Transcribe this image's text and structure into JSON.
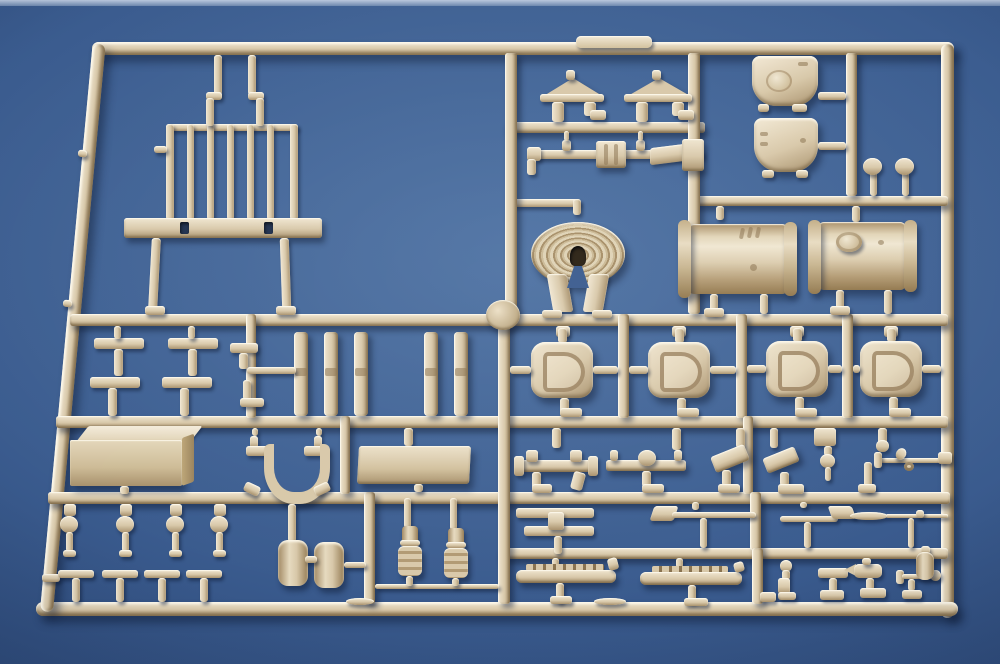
{
  "scene": {
    "type": "photograph",
    "subject": "tan injection-molded plastic model-kit sprue (parts frame) lying on blue felt backdrop",
    "visible_text": "",
    "palette": {
      "bg1": "#4e72a3",
      "bg2": "#3a5b8e",
      "bg3": "#27416e",
      "strip": "#aebfd8",
      "thi": "#f0e6d1",
      "tmid": "#d8c8a9",
      "tlo": "#a8916c",
      "tdk": "#8a7350",
      "hole": "#20314f",
      "cast": "rgba(13,26,50,0.48)",
      "hl": "rgba(255,252,240,0.9)",
      "cr": "rgba(100,80,50,0.55)"
    }
  },
  "sprue": {
    "plastic_color_name": "tan / dark-yellow styrene",
    "frame_shape": "rounded rectangle, left rail slanted by perspective",
    "label_tab_text": "",
    "parts_inventory": [
      {
        "name": "handrail-grille",
        "count": 1
      },
      {
        "name": "roof-shaped-bracket",
        "count": 2
      },
      {
        "name": "axle-rod",
        "count": 1
      },
      {
        "name": "coiled-cable-reel",
        "count": 1
      },
      {
        "name": "curved-stowage-panel",
        "count": 2
      },
      {
        "name": "mushroom-head-pin",
        "count": 2
      },
      {
        "name": "cylindrical-fuel-tank",
        "count": 2
      },
      {
        "name": "d-shaped-hatch-cover",
        "count": 4
      },
      {
        "name": "link-strut",
        "count": 5
      },
      {
        "name": "t-handle-lever",
        "count": 5
      },
      {
        "name": "stowage-box",
        "count": 1
      },
      {
        "name": "mounting-plate",
        "count": 1
      },
      {
        "name": "tow-shackle",
        "count": 1
      },
      {
        "name": "ball-head-pin",
        "count": 4
      },
      {
        "name": "tee-pin",
        "count": 4
      },
      {
        "name": "small-drum",
        "count": 2
      },
      {
        "name": "shock-absorber",
        "count": 2
      },
      {
        "name": "valve-manifold",
        "count": 2
      },
      {
        "name": "angled-bracket",
        "count": 2
      },
      {
        "name": "tapered-pin",
        "count": 1
      },
      {
        "name": "crank-handle-rod",
        "count": 1
      },
      {
        "name": "pedal-assembly",
        "count": 1
      },
      {
        "name": "shovel-tool",
        "count": 2
      },
      {
        "name": "pickaxe-tool",
        "count": 1
      },
      {
        "name": "toothed-rack-bar",
        "count": 2
      },
      {
        "name": "periscope-fitting",
        "count": 1
      },
      {
        "name": "tee-fitting",
        "count": 1
      },
      {
        "name": "nozzle-fitting",
        "count": 1
      },
      {
        "name": "rod-with-ball-end",
        "count": 1
      },
      {
        "name": "small-canister",
        "count": 1
      },
      {
        "name": "molded-label-tab",
        "count": 1
      },
      {
        "name": "round-knockout-disc",
        "count": 1
      }
    ]
  }
}
